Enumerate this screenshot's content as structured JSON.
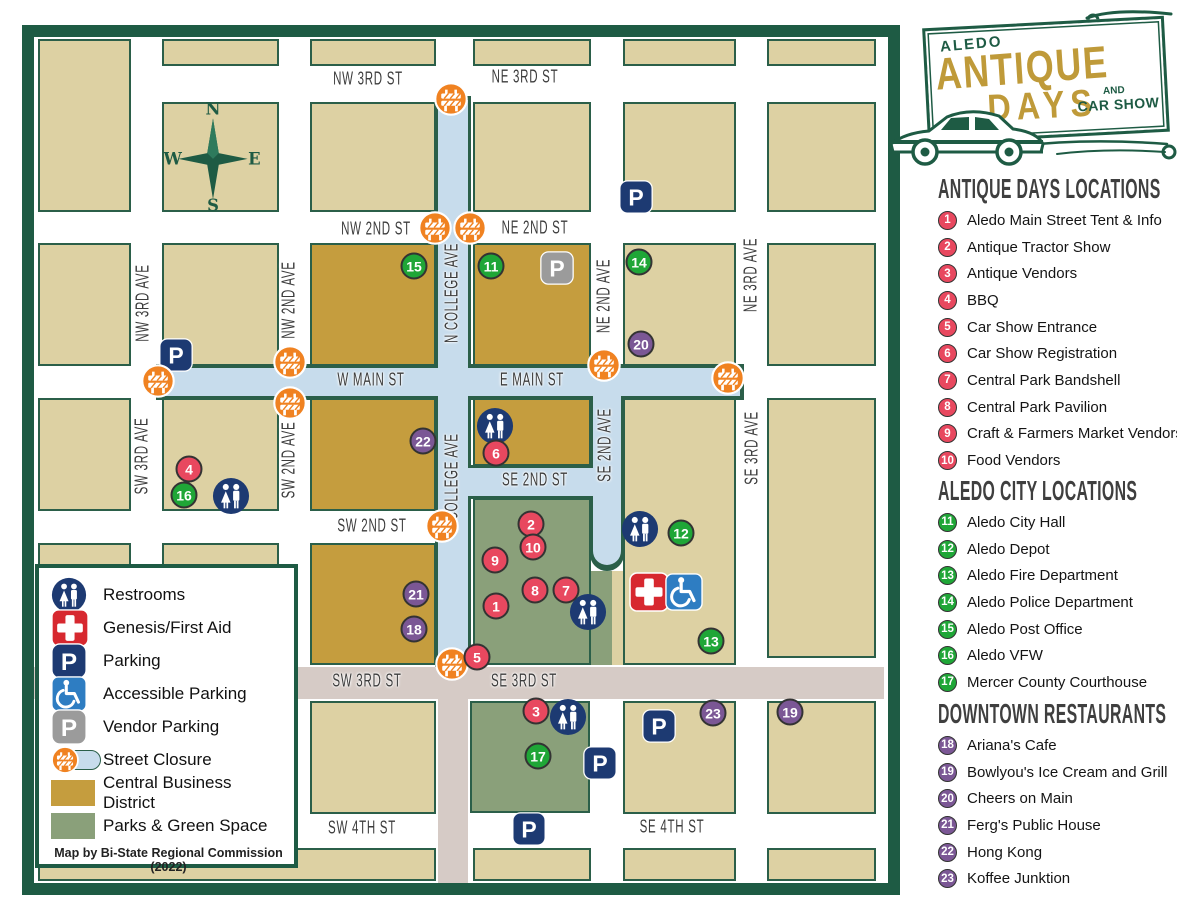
{
  "logo": {
    "city": "ALEDO",
    "line1": "ANTIQUE",
    "line2": "DAYS",
    "and": "AND",
    "carshow": "CAR SHOW"
  },
  "compass": {
    "n": "N",
    "e": "E",
    "s": "S",
    "w": "W"
  },
  "sidebar": {
    "sections": [
      {
        "title": "ANTIQUE DAYS LOCATIONS",
        "color": "#e8485f",
        "items": [
          {
            "num": "1",
            "label": "Aledo Main Street Tent & Info"
          },
          {
            "num": "2",
            "label": "Antique Tractor Show"
          },
          {
            "num": "3",
            "label": "Antique Vendors"
          },
          {
            "num": "4",
            "label": "BBQ"
          },
          {
            "num": "5",
            "label": "Car Show Entrance"
          },
          {
            "num": "6",
            "label": "Car Show Registration"
          },
          {
            "num": "7",
            "label": "Central Park Bandshell"
          },
          {
            "num": "8",
            "label": "Central Park Pavilion"
          },
          {
            "num": "9",
            "label": "Craft & Farmers Market Vendors"
          },
          {
            "num": "10",
            "label": "Food Vendors"
          }
        ]
      },
      {
        "title": "ALEDO CITY LOCATIONS",
        "color": "#1fa637",
        "items": [
          {
            "num": "11",
            "label": "Aledo City Hall"
          },
          {
            "num": "12",
            "label": "Aledo Depot"
          },
          {
            "num": "13",
            "label": "Aledo Fire Department"
          },
          {
            "num": "14",
            "label": "Aledo Police Department"
          },
          {
            "num": "15",
            "label": "Aledo Post Office"
          },
          {
            "num": "16",
            "label": "Aledo VFW"
          },
          {
            "num": "17",
            "label": "Mercer County Courthouse"
          }
        ]
      },
      {
        "title": "DOWNTOWN RESTAURANTS",
        "color": "#7b5795",
        "items": [
          {
            "num": "18",
            "label": "Ariana's Cafe"
          },
          {
            "num": "19",
            "label": "Bowlyou's Ice Cream and Grill"
          },
          {
            "num": "20",
            "label": "Cheers on Main"
          },
          {
            "num": "21",
            "label": "Ferg's Public House"
          },
          {
            "num": "22",
            "label": "Hong Kong"
          },
          {
            "num": "23",
            "label": "Koffee Junktion"
          }
        ]
      }
    ]
  },
  "legend": {
    "items": [
      {
        "icon": "restroom",
        "label": "Restrooms"
      },
      {
        "icon": "firstaid",
        "label": "Genesis/First Aid"
      },
      {
        "icon": "parking",
        "label": "Parking"
      },
      {
        "icon": "accessible",
        "label": "Accessible Parking"
      },
      {
        "icon": "vendor",
        "label": "Vendor Parking"
      },
      {
        "icon": "closure",
        "label": "Street Closure"
      },
      {
        "icon": "swatch_cbd",
        "label": "Central Business District"
      },
      {
        "icon": "swatch_park",
        "label": "Parks & Green Space"
      }
    ],
    "credit": "Map by Bi-State Regional Commission (2022)"
  },
  "map": {
    "parking_letter": "P",
    "colors": {
      "event": "#e8485f",
      "city": "#1fa637",
      "restaurant": "#7b5795",
      "navy": "#1d3a72",
      "accessible": "#2e7dc2",
      "vendor": "#9b9b9b",
      "orange": "#f08221",
      "red_cross": "#d7282f",
      "cbd": "#c59d3e",
      "park": "#8aa07a",
      "closure": "#c7dcec",
      "highway": "#d6cbc6",
      "border_green": "#1e5b44"
    },
    "street_labels": [
      {
        "text": "NW 3RD ST",
        "x": 368,
        "y": 80
      },
      {
        "text": "NE 3RD ST",
        "x": 525,
        "y": 78
      },
      {
        "text": "NW 2ND ST",
        "x": 376,
        "y": 230
      },
      {
        "text": "NE 2ND ST",
        "x": 535,
        "y": 229
      },
      {
        "text": "W MAIN ST",
        "x": 371,
        "y": 381
      },
      {
        "text": "E MAIN ST",
        "x": 532,
        "y": 381
      },
      {
        "text": "SE 2ND ST",
        "x": 535,
        "y": 481
      },
      {
        "text": "SW 2ND ST",
        "x": 372,
        "y": 527
      },
      {
        "text": "SW 3RD ST",
        "x": 367,
        "y": 682
      },
      {
        "text": "SE 3RD ST",
        "x": 524,
        "y": 682
      },
      {
        "text": "SW 4TH ST",
        "x": 362,
        "y": 829
      },
      {
        "text": "SE 4TH ST",
        "x": 672,
        "y": 828
      },
      {
        "text": "NW 3RD AVE",
        "x": 144,
        "y": 303,
        "vert": true
      },
      {
        "text": "SW 3RD AVE",
        "x": 143,
        "y": 456,
        "vert": true
      },
      {
        "text": "NW 2ND AVE",
        "x": 290,
        "y": 300,
        "vert": true
      },
      {
        "text": "SW 2ND AVE",
        "x": 290,
        "y": 460,
        "vert": true
      },
      {
        "text": "N COLLEGE AVE",
        "x": 453,
        "y": 293,
        "vert": true
      },
      {
        "text": "S COLLEGE AVE",
        "x": 453,
        "y": 483,
        "vert": true
      },
      {
        "text": "NE 2ND AVE",
        "x": 605,
        "y": 296,
        "vert": true
      },
      {
        "text": "SE 2ND AVE",
        "x": 606,
        "y": 445,
        "vert": true
      },
      {
        "text": "NE 3RD AVE",
        "x": 752,
        "y": 275,
        "vert": true
      },
      {
        "text": "SE 3RD AVE",
        "x": 753,
        "y": 448,
        "vert": true
      }
    ],
    "markers": [
      {
        "num": "1",
        "x": 496,
        "y": 606,
        "cat": "event"
      },
      {
        "num": "2",
        "x": 531,
        "y": 524,
        "cat": "event"
      },
      {
        "num": "3",
        "x": 536,
        "y": 711,
        "cat": "event"
      },
      {
        "num": "4",
        "x": 189,
        "y": 469,
        "cat": "event"
      },
      {
        "num": "5",
        "x": 477,
        "y": 657,
        "cat": "event"
      },
      {
        "num": "6",
        "x": 496,
        "y": 453,
        "cat": "event"
      },
      {
        "num": "7",
        "x": 566,
        "y": 590,
        "cat": "event"
      },
      {
        "num": "8",
        "x": 535,
        "y": 590,
        "cat": "event"
      },
      {
        "num": "9",
        "x": 495,
        "y": 560,
        "cat": "event"
      },
      {
        "num": "10",
        "x": 533,
        "y": 547,
        "cat": "event"
      },
      {
        "num": "11",
        "x": 491,
        "y": 266,
        "cat": "city"
      },
      {
        "num": "12",
        "x": 681,
        "y": 533,
        "cat": "city"
      },
      {
        "num": "13",
        "x": 711,
        "y": 641,
        "cat": "city"
      },
      {
        "num": "14",
        "x": 639,
        "y": 262,
        "cat": "city"
      },
      {
        "num": "15",
        "x": 414,
        "y": 266,
        "cat": "city"
      },
      {
        "num": "16",
        "x": 184,
        "y": 495,
        "cat": "city"
      },
      {
        "num": "17",
        "x": 538,
        "y": 756,
        "cat": "city"
      },
      {
        "num": "18",
        "x": 414,
        "y": 629,
        "cat": "restaurant"
      },
      {
        "num": "19",
        "x": 790,
        "y": 712,
        "cat": "restaurant"
      },
      {
        "num": "20",
        "x": 641,
        "y": 344,
        "cat": "restaurant"
      },
      {
        "num": "21",
        "x": 416,
        "y": 594,
        "cat": "restaurant"
      },
      {
        "num": "22",
        "x": 423,
        "y": 441,
        "cat": "restaurant"
      },
      {
        "num": "23",
        "x": 713,
        "y": 713,
        "cat": "restaurant"
      }
    ],
    "icons": [
      {
        "type": "restroom",
        "x": 231,
        "y": 496
      },
      {
        "type": "restroom",
        "x": 495,
        "y": 426
      },
      {
        "type": "restroom",
        "x": 588,
        "y": 612
      },
      {
        "type": "restroom",
        "x": 640,
        "y": 529
      },
      {
        "type": "restroom",
        "x": 568,
        "y": 717
      },
      {
        "type": "firstaid",
        "x": 649,
        "y": 592
      },
      {
        "type": "accessible",
        "x": 684,
        "y": 592
      },
      {
        "type": "parking",
        "x": 176,
        "y": 355
      },
      {
        "type": "parking",
        "x": 636,
        "y": 197
      },
      {
        "type": "parking",
        "x": 659,
        "y": 726
      },
      {
        "type": "parking",
        "x": 600,
        "y": 763
      },
      {
        "type": "parking",
        "x": 529,
        "y": 829
      },
      {
        "type": "vendor",
        "x": 557,
        "y": 268
      },
      {
        "type": "barricade",
        "x": 451,
        "y": 99
      },
      {
        "type": "barricade",
        "x": 435,
        "y": 228
      },
      {
        "type": "barricade",
        "x": 470,
        "y": 228
      },
      {
        "type": "barricade",
        "x": 158,
        "y": 381
      },
      {
        "type": "barricade",
        "x": 290,
        "y": 362
      },
      {
        "type": "barricade",
        "x": 290,
        "y": 403
      },
      {
        "type": "barricade",
        "x": 604,
        "y": 365
      },
      {
        "type": "barricade",
        "x": 728,
        "y": 378
      },
      {
        "type": "barricade",
        "x": 442,
        "y": 526
      },
      {
        "type": "barricade",
        "x": 452,
        "y": 664
      }
    ]
  }
}
